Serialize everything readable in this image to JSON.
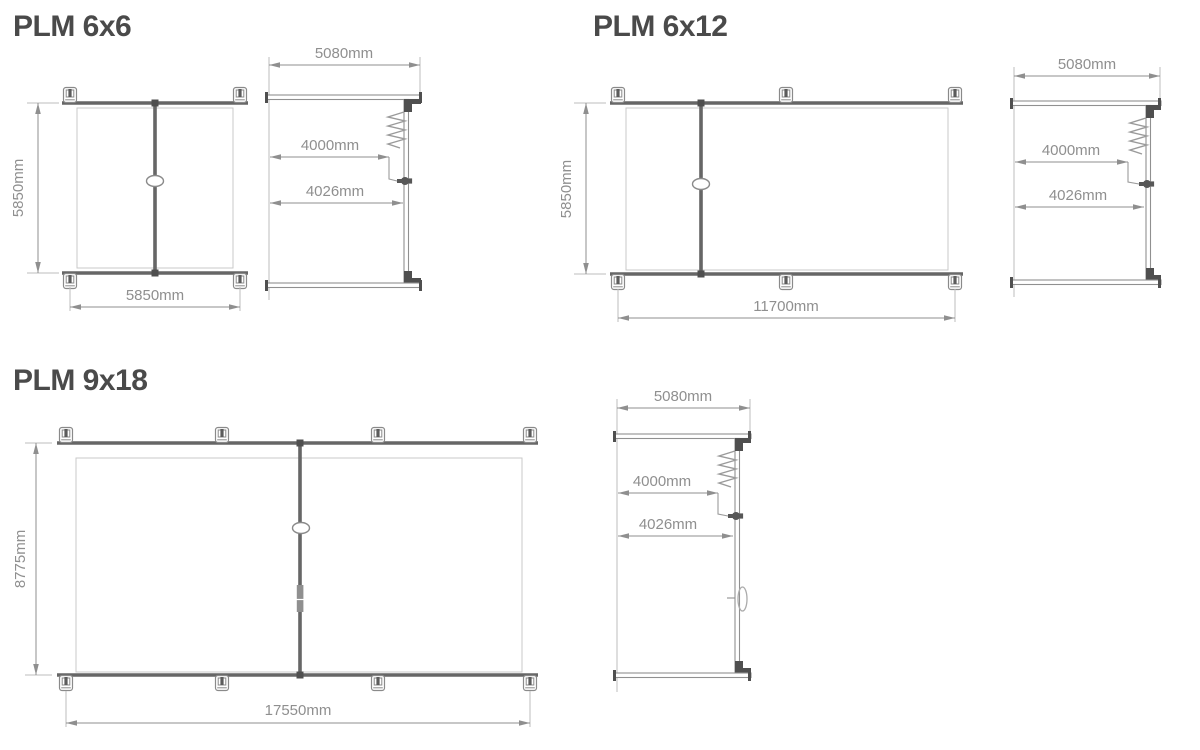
{
  "document": {
    "background": "#ffffff",
    "type_label": "tent-frame-dimension-diagrams"
  },
  "colors": {
    "title_text": "#4a4a4a",
    "dimension_text": "#8f8f8f",
    "frame_dark": "#666666",
    "frame_light": "#c9c9c9",
    "detail_dark": "#4f4f4f"
  },
  "panels": [
    {
      "title": "PLM 6x6",
      "plan": {
        "width": "5850mm",
        "depth": "5850mm"
      },
      "side": {
        "width": "5080mm",
        "inner_height": "4000mm",
        "outer_height": "4026mm"
      }
    },
    {
      "title": "PLM 6x12",
      "plan": {
        "width": "11700mm",
        "depth": "5850mm"
      },
      "side": {
        "width": "5080mm",
        "inner_height": "4000mm",
        "outer_height": "4026mm"
      }
    },
    {
      "title": "PLM 9x18",
      "plan": {
        "width": "17550mm",
        "depth": "8775mm"
      },
      "side": {
        "width": "5080mm",
        "inner_height": "4000mm",
        "outer_height": "4026mm"
      }
    }
  ]
}
